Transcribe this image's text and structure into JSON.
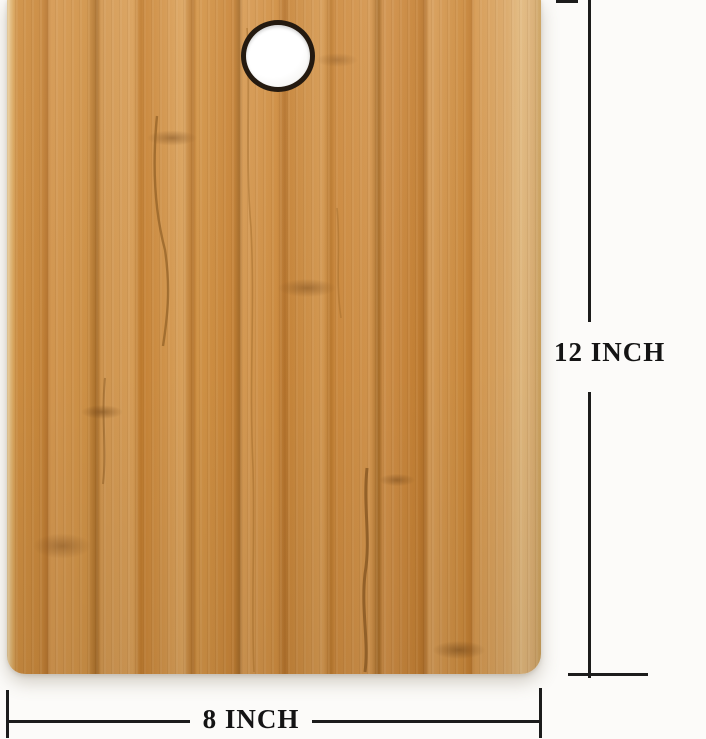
{
  "figure": {
    "kind": "product-dimension-photo",
    "subject": "bamboo-cutting-board-with-hanging-hole"
  },
  "labels": {
    "height": "12 INCH",
    "width": "8 INCH"
  },
  "theme": {
    "background": "#fcfbf9",
    "line_color": "#1c1c1c",
    "label_color": "#141414",
    "hole_ring": "#241a10",
    "hole_fill": "#ffffff",
    "wood_light": "#dca45e",
    "wood_mid": "#cd8a3e",
    "wood_dark": "#a86d28",
    "wood_edge_highlight": "#ecd2a2"
  }
}
